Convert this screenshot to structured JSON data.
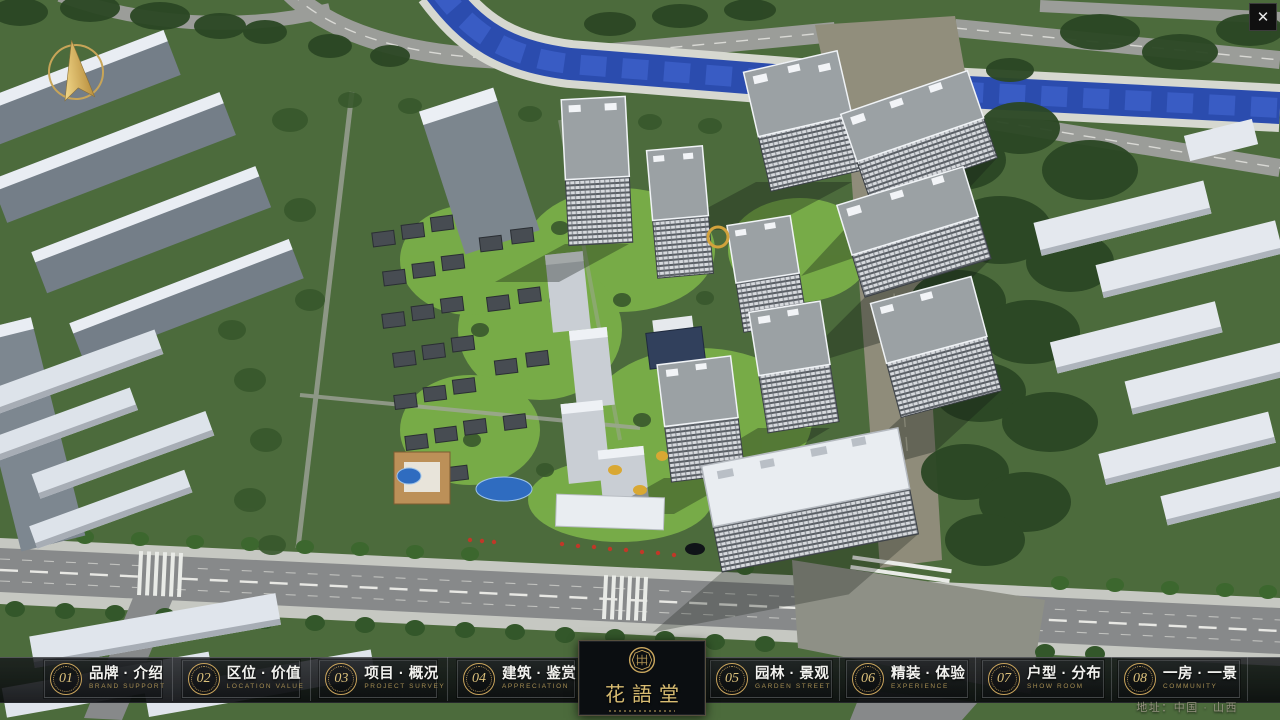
{
  "window": {
    "close_icon": "✕"
  },
  "navbar": {
    "items": [
      {
        "number": "01",
        "title_zh": "品牌 · 介绍",
        "title_en": "BRAND SUPPORT"
      },
      {
        "number": "02",
        "title_zh": "区位 · 价值",
        "title_en": "LOCATION VALUE"
      },
      {
        "number": "03",
        "title_zh": "项目 · 概况",
        "title_en": "PROJECT SURVEY"
      },
      {
        "number": "04",
        "title_zh": "建筑 · 鉴赏",
        "title_en": "APPRECIATION"
      },
      {
        "number": "05",
        "title_zh": "园林 · 景观",
        "title_en": "GARDEN STREET"
      },
      {
        "number": "06",
        "title_zh": "精装 · 体验",
        "title_en": "EXPERIENCE"
      },
      {
        "number": "07",
        "title_zh": "户型 · 分布",
        "title_en": "SHOW ROOM"
      },
      {
        "number": "08",
        "title_zh": "一房 · 一景",
        "title_en": "COMMUNITY"
      }
    ]
  },
  "logo": {
    "title": "花語堂"
  },
  "footer": {
    "address": "地址：中国 · 山西"
  },
  "icons": {
    "compass": "north-arrow",
    "seal": "brand-seal"
  },
  "colors": {
    "accent_gold": "#c9a45c",
    "bar_background": "#14161a",
    "river_blue": "#2b4cae",
    "lawn_green": "#7cb349",
    "road_gray": "#87898a",
    "khaki_road": "#8f8c7a"
  }
}
